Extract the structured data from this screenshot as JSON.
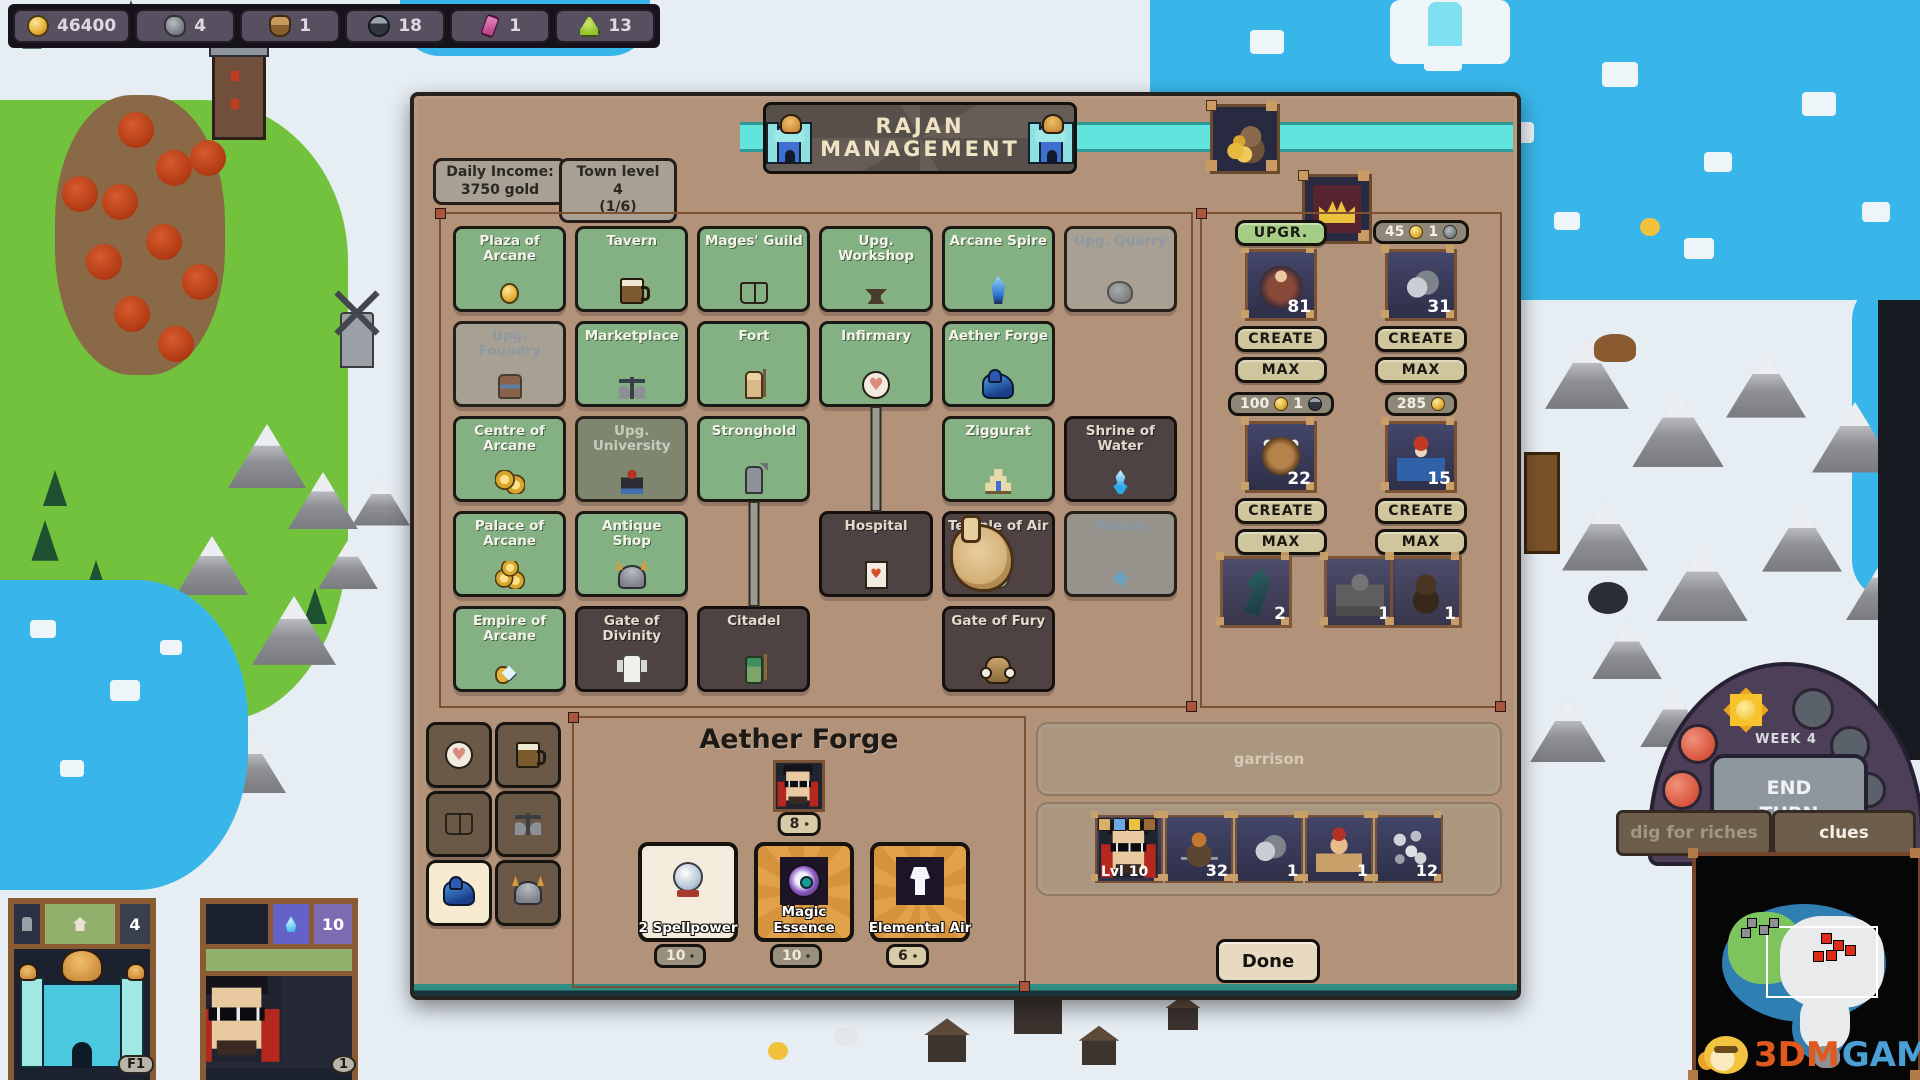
{
  "resources": [
    {
      "name": "gold",
      "value": "46400",
      "icon": "gold"
    },
    {
      "name": "ore",
      "value": "4",
      "icon": "ore"
    },
    {
      "name": "wood",
      "value": "1",
      "icon": "wood"
    },
    {
      "name": "mercury",
      "value": "18",
      "icon": "mercury"
    },
    {
      "name": "crystal",
      "value": "1",
      "icon": "crystal"
    },
    {
      "name": "gems",
      "value": "13",
      "icon": "gems"
    }
  ],
  "dialog": {
    "title_line1": "RAJAN",
    "title_line2": "MANAGEMENT",
    "income_label": "Daily Income:",
    "income_value": "3750 gold",
    "level_label": "Town level 4",
    "level_value": "(1/6)",
    "buildings": [
      {
        "label": "Plaza of Arcane",
        "state": "built",
        "icon": "coin",
        "row": 1,
        "col": 1,
        "down": true
      },
      {
        "label": "Tavern",
        "state": "built",
        "icon": "mug",
        "row": 1,
        "col": 2,
        "down": true
      },
      {
        "label": "Mages' Guild",
        "state": "built",
        "icon": "book",
        "row": 1,
        "col": 3,
        "down": true,
        "right": true
      },
      {
        "label": "Upg. Workshop",
        "state": "built",
        "icon": "anvil",
        "row": 1,
        "col": 4,
        "down": true
      },
      {
        "label": "Arcane Spire",
        "state": "built",
        "icon": "spire",
        "row": 1,
        "col": 5,
        "down": true,
        "right": true
      },
      {
        "label": "Upg. Quarry",
        "state": "upgrade",
        "icon": "rock",
        "row": 1,
        "col": 6
      },
      {
        "label": "Upg. Foundry",
        "state": "upgrade",
        "icon": "armor",
        "row": 2,
        "col": 1,
        "down": true
      },
      {
        "label": "Marketplace",
        "state": "built",
        "icon": "scales",
        "row": 2,
        "col": 2,
        "down": true
      },
      {
        "label": "Fort",
        "state": "built",
        "icon": "guard",
        "row": 2,
        "col": 3,
        "down": true,
        "right": true
      },
      {
        "label": "Infirmary",
        "state": "built",
        "icon": "heart",
        "row": 2,
        "col": 4,
        "down": true
      },
      {
        "label": "Aether Forge",
        "state": "built",
        "icon": "forge",
        "row": 2,
        "col": 5,
        "down": true
      },
      {
        "label": "Centre of Arcane",
        "state": "built",
        "icon": "coins2",
        "row": 3,
        "col": 1,
        "down": true
      },
      {
        "label": "Upg. University",
        "state": "upgrade2",
        "icon": "scholar",
        "row": 3,
        "col": 2,
        "down": true
      },
      {
        "label": "Stronghold",
        "state": "built",
        "icon": "soldier",
        "row": 3,
        "col": 3,
        "down": true
      },
      {
        "label": "Ziggurat",
        "state": "built",
        "icon": "ziggurat",
        "row": 3,
        "col": 5,
        "down": true
      },
      {
        "label": "Shrine of Water",
        "state": "unbuilt",
        "icon": "waterflame",
        "row": 3,
        "col": 6,
        "down": true
      },
      {
        "label": "Palace of Arcane",
        "state": "built",
        "icon": "coins3",
        "row": 4,
        "col": 1,
        "down": true
      },
      {
        "label": "Antique Shop",
        "state": "built",
        "icon": "helm",
        "row": 4,
        "col": 2,
        "down": true
      },
      {
        "label": "Hospital",
        "state": "unbuilt",
        "icon": "cardheart",
        "row": 4,
        "col": 4
      },
      {
        "label": "Temple of Air",
        "state": "unbuilt",
        "icon": "sack",
        "row": 4,
        "col": 5,
        "down": true
      },
      {
        "label": "Palace",
        "state": "locked",
        "icon": "palacegem",
        "row": 4,
        "col": 6
      },
      {
        "label": "Empire of Arcane",
        "state": "built",
        "icon": "diamond",
        "row": 5,
        "col": 1
      },
      {
        "label": "Gate of Divinity",
        "state": "unbuilt",
        "icon": "angel",
        "row": 5,
        "col": 2
      },
      {
        "label": "Citadel",
        "state": "unbuilt",
        "icon": "wizard",
        "row": 5,
        "col": 3
      },
      {
        "label": "Gate of Fury",
        "state": "unbuilt",
        "icon": "demon",
        "row": 5,
        "col": 5
      }
    ],
    "recruits": [
      {
        "name": "dwarf",
        "costs": [
          {
            "value": "50",
            "icon": "gold"
          }
        ],
        "count": "81",
        "sprite": "dwarf",
        "col": 0,
        "slot": 0,
        "buttons": [
          {
            "label": "CREATE",
            "style": "tan"
          },
          {
            "label": "MAX",
            "style": "tan"
          },
          {
            "label": "UPGR.",
            "style": "green"
          }
        ]
      },
      {
        "name": "rat",
        "costs": [
          {
            "value": "45",
            "icon": "gold"
          },
          {
            "value": "1",
            "icon": "ore"
          }
        ],
        "count": "31",
        "sprite": "rat",
        "col": 1,
        "slot": 0,
        "buttons": [
          {
            "label": "CREATE",
            "style": "tan"
          },
          {
            "label": "MAX",
            "style": "tan"
          }
        ]
      },
      {
        "name": "gargoyle",
        "costs": [
          {
            "value": "100",
            "icon": "gold"
          },
          {
            "value": "1",
            "icon": "mercury"
          }
        ],
        "count": "22",
        "sprite": "gargoyle",
        "col": 0,
        "slot": 1,
        "buttons": [
          {
            "label": "CREATE",
            "style": "tan"
          },
          {
            "label": "MAX",
            "style": "tan"
          }
        ]
      },
      {
        "name": "mage",
        "costs": [
          {
            "value": "285",
            "icon": "gold"
          }
        ],
        "count": "15",
        "sprite": "mage",
        "col": 1,
        "slot": 1,
        "buttons": [
          {
            "label": "CREATE",
            "style": "tan"
          },
          {
            "label": "MAX",
            "style": "tan"
          }
        ]
      }
    ],
    "reserve": [
      {
        "count": "2",
        "sprite": "elemental"
      },
      {
        "count": "1",
        "sprite": "golem"
      },
      {
        "count": "1",
        "sprite": "bear"
      }
    ],
    "sidebar": [
      {
        "name": "infirmary",
        "icon": "heart",
        "selected": false
      },
      {
        "name": "tavern",
        "icon": "mug",
        "selected": false
      },
      {
        "name": "mages-guild",
        "icon": "book",
        "selected": false
      },
      {
        "name": "marketplace",
        "icon": "scales",
        "selected": false
      },
      {
        "name": "aether-forge",
        "icon": "forge",
        "selected": true
      },
      {
        "name": "antique-shop",
        "icon": "helm",
        "selected": false
      }
    ],
    "detail": {
      "title": "Aether Forge",
      "hero_cost": "8",
      "items": [
        {
          "label": "2 Spellpower",
          "cost": "10",
          "lit": false,
          "icon": "orb",
          "bg": "plain"
        },
        {
          "label": "Magic Essence",
          "cost": "10",
          "lit": false,
          "icon": "eye",
          "bg": "ornate"
        },
        {
          "label": "Elemental Air",
          "cost": "6",
          "lit": true,
          "icon": "air",
          "bg": "ornate"
        }
      ]
    },
    "garrison_label": "garrison",
    "army": [
      {
        "label": "Lvl 10",
        "sprite": "hero"
      },
      {
        "label": "32",
        "sprite": "archer"
      },
      {
        "label": "1",
        "sprite": "rat"
      },
      {
        "label": "1",
        "sprite": "brawler"
      },
      {
        "label": "12",
        "sprite": "flies"
      }
    ],
    "done_label": "Done"
  },
  "hud": {
    "week": "WEEK 4",
    "end_turn": "END TURN",
    "dig": "dig for riches",
    "clues": "clues",
    "town_count": "4",
    "town_hotkey": "F1",
    "hero_mana": "10",
    "hero_badge": "1",
    "wm_orange": "3DM",
    "wm_blue": "GAME"
  }
}
